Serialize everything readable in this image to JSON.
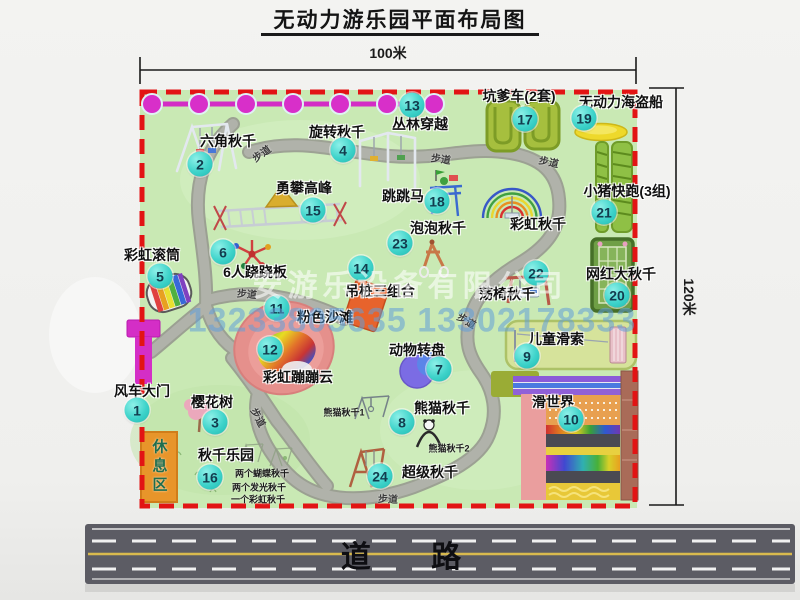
{
  "title": "无动力游乐园平面布局图",
  "dimension_top": "100米",
  "dimension_right": "120米",
  "road_label": "道 路",
  "rest_area_label": "休息区",
  "watermark": {
    "company": "安游乐设备有限公司",
    "phones": "13233805635 13302178333"
  },
  "colors": {
    "map_bg": "#c9e9b4",
    "border_dash": "#e21414",
    "zipline": "#d32cc5",
    "badge": "#3ed3ca",
    "road": "#5c5c64"
  },
  "attractions": [
    {
      "id": "windmill-gate",
      "num": "1",
      "name": "风车大门",
      "lx": 142,
      "ly": 391,
      "bx": 137,
      "by": 410
    },
    {
      "id": "hex-swing",
      "num": "2",
      "name": "六角秋千",
      "lx": 228,
      "ly": 141,
      "bx": 200,
      "by": 164
    },
    {
      "id": "cherry-tree",
      "num": "3",
      "name": "樱花树",
      "lx": 212,
      "ly": 402,
      "bx": 215,
      "by": 422
    },
    {
      "id": "rotating-swing",
      "num": "4",
      "name": "旋转秋千",
      "lx": 337,
      "ly": 132,
      "bx": 343,
      "by": 150
    },
    {
      "id": "rainbow-roller",
      "num": "5",
      "name": "彩虹滚筒",
      "lx": 152,
      "ly": 255,
      "bx": 160,
      "by": 276
    },
    {
      "id": "six-seesaw",
      "num": "6",
      "name": "6人跷跷板",
      "lx": 255,
      "ly": 272,
      "bx": 223,
      "by": 252
    },
    {
      "id": "animal-carousel",
      "num": "7",
      "name": "动物转盘",
      "lx": 417,
      "ly": 350,
      "bx": 439,
      "by": 369
    },
    {
      "id": "panda-swing",
      "num": "8",
      "name": "熊猫秋千",
      "lx": 442,
      "ly": 408,
      "bx": 402,
      "by": 422
    },
    {
      "id": "kids-zipline",
      "num": "9",
      "name": "儿童滑索",
      "lx": 556,
      "ly": 339,
      "bx": 527,
      "by": 356
    },
    {
      "id": "slide-world",
      "num": "10",
      "name": "滑世界",
      "lx": 553,
      "ly": 402,
      "bx": 571,
      "by": 419
    },
    {
      "id": "pink-beach",
      "num": "11",
      "name": "粉色沙滩",
      "lx": 325,
      "ly": 317,
      "bx": 277,
      "by": 308
    },
    {
      "id": "rainbow-cloud",
      "num": "12",
      "name": "彩虹蹦蹦云",
      "lx": 298,
      "ly": 377,
      "bx": 270,
      "by": 349
    },
    {
      "id": "jungle-crossing",
      "num": "13",
      "name": "丛林穿越",
      "lx": 420,
      "ly": 124,
      "bx": 412,
      "by": 105
    },
    {
      "id": "hanging-piles",
      "num": "14",
      "name": "吊桩三组合",
      "lx": 380,
      "ly": 291,
      "bx": 361,
      "by": 268
    },
    {
      "id": "climbing-peak",
      "num": "15",
      "name": "勇攀高峰",
      "lx": 304,
      "ly": 188,
      "bx": 313,
      "by": 210
    },
    {
      "id": "swing-park",
      "num": "16",
      "name": "秋千乐园",
      "lx": 226,
      "ly": 455,
      "bx": 210,
      "by": 477
    },
    {
      "id": "pit-cars",
      "num": "17",
      "name": "坑爹车(2套)",
      "lx": 519,
      "ly": 96,
      "bx": 525,
      "by": 119
    },
    {
      "id": "jumping-horse",
      "num": "18",
      "name": "跳跳马",
      "lx": 403,
      "ly": 196,
      "bx": 437,
      "by": 201
    },
    {
      "id": "pirate-ship",
      "num": "19",
      "name": "无动力海盗船",
      "lx": 621,
      "ly": 102,
      "bx": 584,
      "by": 118
    },
    {
      "id": "big-swing",
      "num": "20",
      "name": "网红大秋千",
      "lx": 621,
      "ly": 274,
      "bx": 617,
      "by": 295
    },
    {
      "id": "piggy-run",
      "num": "21",
      "name": "小猪快跑(3组)",
      "lx": 627,
      "ly": 191,
      "bx": 604,
      "by": 212
    },
    {
      "id": "chair-swing",
      "num": "22",
      "name": "荡椅秋千",
      "lx": 507,
      "ly": 294,
      "bx": 536,
      "by": 273
    },
    {
      "id": "bubble-swing",
      "num": "23",
      "name": "泡泡秋千",
      "lx": 438,
      "ly": 228,
      "bx": 400,
      "by": 243
    },
    {
      "id": "super-swing",
      "num": "24",
      "name": "超级秋千",
      "lx": 430,
      "ly": 472,
      "bx": 380,
      "by": 476
    },
    {
      "id": "rainbow-swing",
      "num": null,
      "name": "彩虹秋千",
      "lx": 538,
      "ly": 224
    }
  ],
  "path_labels": [
    {
      "text": "步道",
      "x": 261,
      "y": 153,
      "rot": -35
    },
    {
      "text": "步道",
      "x": 441,
      "y": 158,
      "rot": 8
    },
    {
      "text": "步道",
      "x": 549,
      "y": 161,
      "rot": 12
    },
    {
      "text": "步道",
      "x": 247,
      "y": 293,
      "rot": 5
    },
    {
      "text": "步道",
      "x": 467,
      "y": 320,
      "rot": 30
    },
    {
      "text": "步道",
      "x": 259,
      "y": 417,
      "rot": 62
    },
    {
      "text": "步道",
      "x": 388,
      "y": 498,
      "rot": 3
    }
  ],
  "notes": [
    {
      "text": "熊猫秋千1",
      "x": 344,
      "y": 412
    },
    {
      "text": "熊猫秋千2",
      "x": 449,
      "y": 448
    },
    {
      "text": "两个蝴蝶秋千",
      "x": 262,
      "y": 473
    },
    {
      "text": "两个发光秋千",
      "x": 259,
      "y": 487
    },
    {
      "text": "一个彩虹秋千",
      "x": 258,
      "y": 499
    }
  ]
}
